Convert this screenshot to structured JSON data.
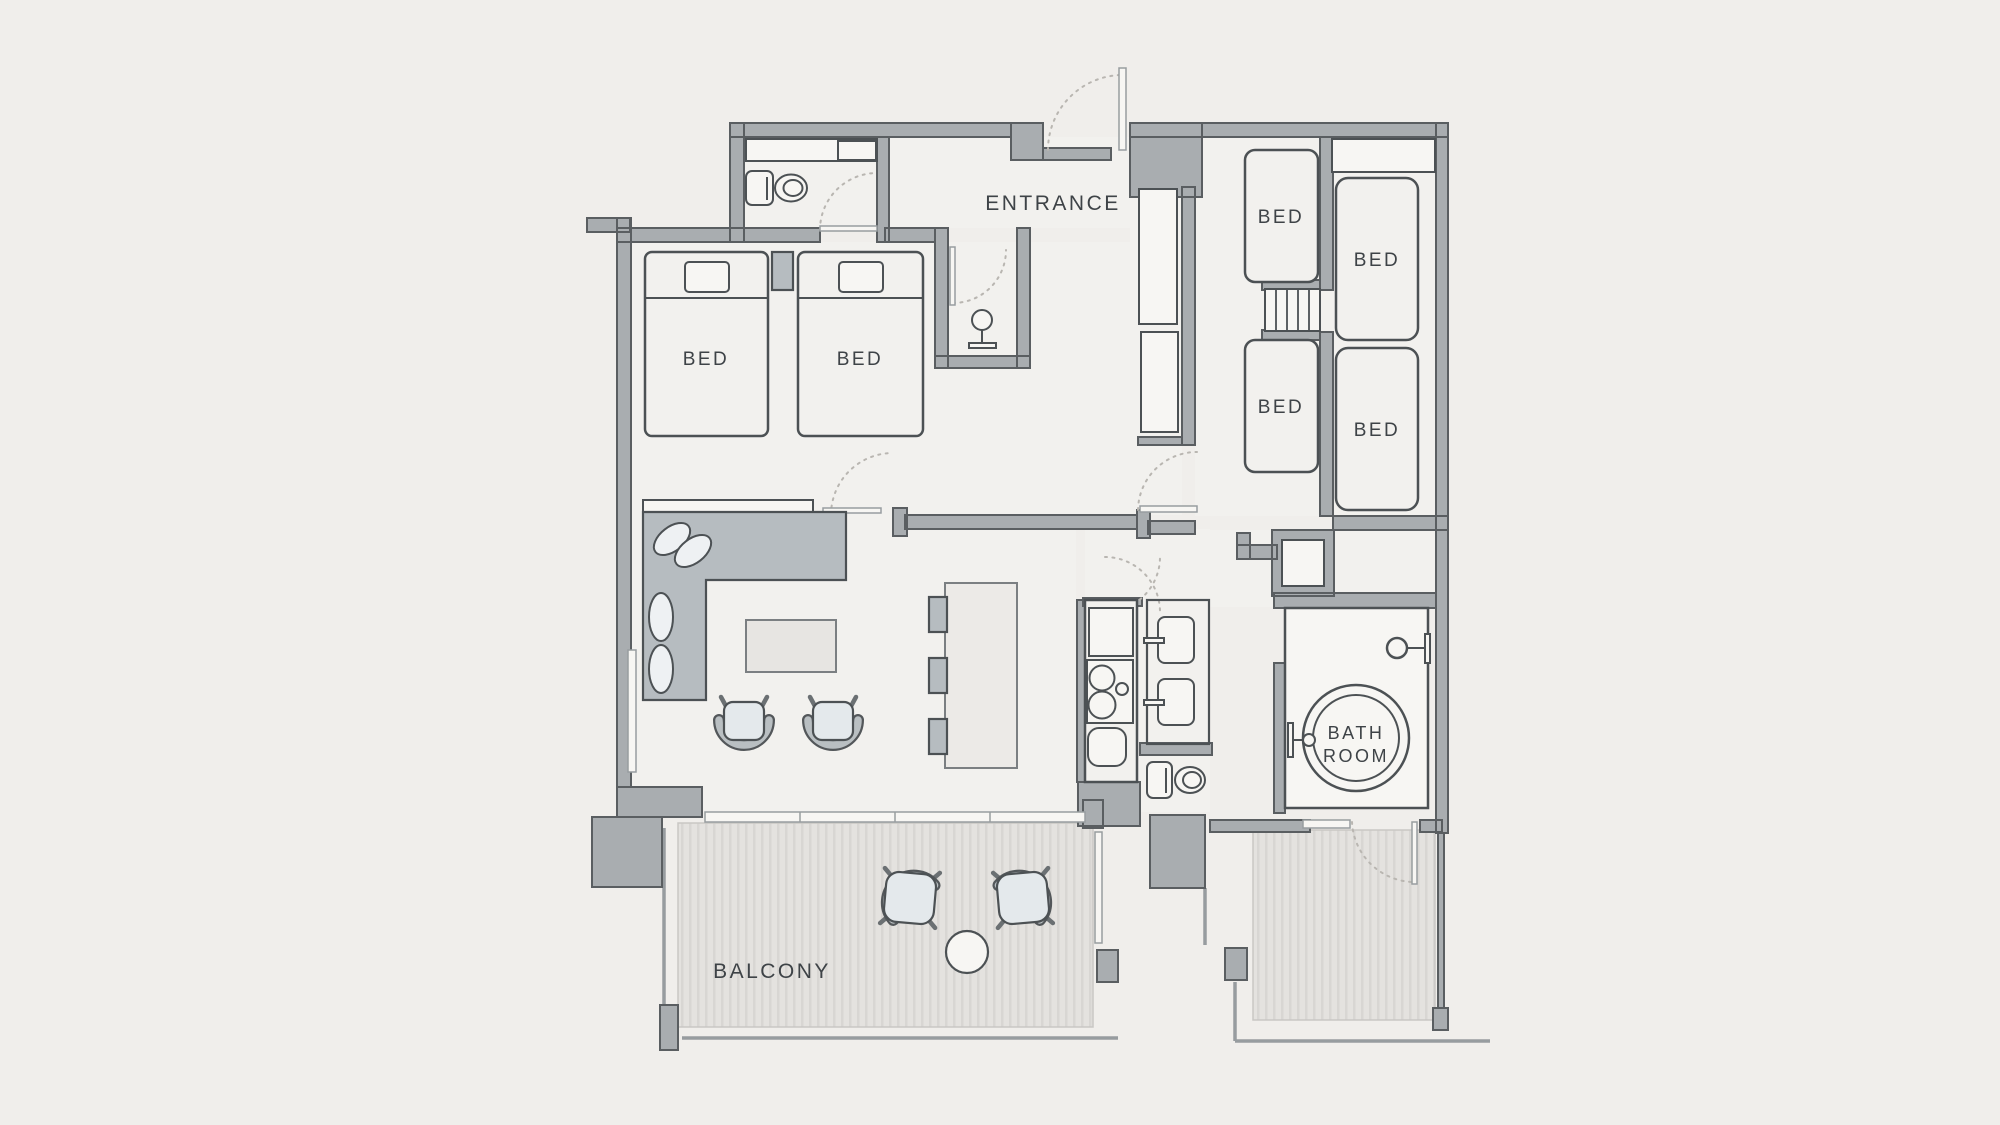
{
  "floorplan": {
    "type": "apartment-floor-plan",
    "labels": {
      "entrance": "ENTRANCE",
      "beds": [
        "BED",
        "BED",
        "BED",
        "BED",
        "BED",
        "BED"
      ],
      "bathroom": [
        "BATH",
        "ROOM"
      ],
      "balcony": "BALCONY"
    },
    "colors": {
      "background": "#f0eeeb",
      "floor": "#f2f1ee",
      "wall_fill": "#a9adb0",
      "wall_stroke": "#5a5e61",
      "line_dark": "#4c5154",
      "sofa_fill": "#b6bcc0",
      "cushion_fill": "#eef1f3",
      "seat_fill": "#e4e9ec",
      "table_fill": "#e7e5e2",
      "island_fill": "#eceae7",
      "balcony_floor": "#e4e2df",
      "balcony_stripe": "#d8d6d3",
      "door_arc": "#b9b6b1",
      "window_fill": "#f7f6f3",
      "text": "#3e4347"
    }
  }
}
